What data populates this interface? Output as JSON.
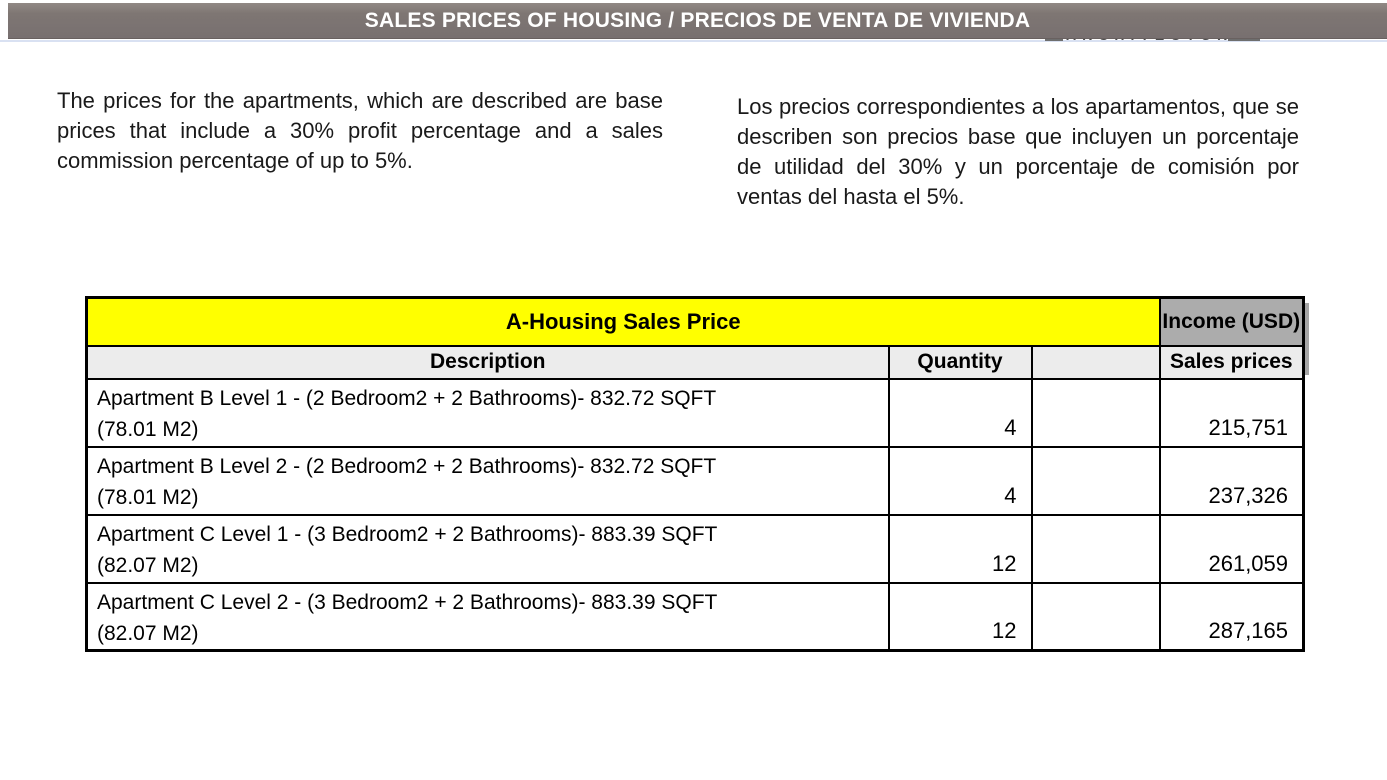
{
  "header": {
    "title": "SALES PRICES OF HOUSING / PRECIOS DE VENTA DE VIVIENDA",
    "logo_fragment": "ARCHITECTURE",
    "bar_color": "#7e7673",
    "underline_color": "#d9e1f2"
  },
  "intro": {
    "english": "The prices for the apartments, which are described are base prices that include a 30% profit percentage and a sales commission percentage of up to 5%.",
    "spanish": "Los precios correspondientes a los apartamentos, que se describen son precios base que incluyen un porcentaje de utilidad del 30% y un porcentaje de comisión por ventas del hasta el 5%."
  },
  "table": {
    "title": "A-Housing Sales Price",
    "income_header": "Income (USD)",
    "columns": {
      "description": "Description",
      "quantity": "Quantity",
      "spacer": "",
      "sales_prices": "Sales prices"
    },
    "colors": {
      "title_bg": "#ffff00",
      "income_bg": "#acacac",
      "header_bg": "#ececec",
      "border": "#000000"
    },
    "rows": [
      {
        "desc_line1": "Apartment B Level 1 -  (2 Bedroom2 + 2 Bathrooms)- 832.72 SQFT",
        "desc_line2": "(78.01 M2)",
        "quantity": "4",
        "sales_price": "215,751"
      },
      {
        "desc_line1": "Apartment B Level 2 - (2 Bedroom2 + 2 Bathrooms)- 832.72 SQFT",
        "desc_line2": "(78.01 M2)",
        "quantity": "4",
        "sales_price": "237,326"
      },
      {
        "desc_line1": "Apartment C Level 1 - (3 Bedroom2 + 2 Bathrooms)- 883.39 SQFT",
        "desc_line2": "(82.07 M2)",
        "quantity": "12",
        "sales_price": "261,059"
      },
      {
        "desc_line1": "Apartment C Level 2 - (3 Bedroom2 + 2 Bathrooms)- 883.39 SQFT",
        "desc_line2": "(82.07 M2)",
        "quantity": "12",
        "sales_price": "287,165"
      }
    ]
  }
}
